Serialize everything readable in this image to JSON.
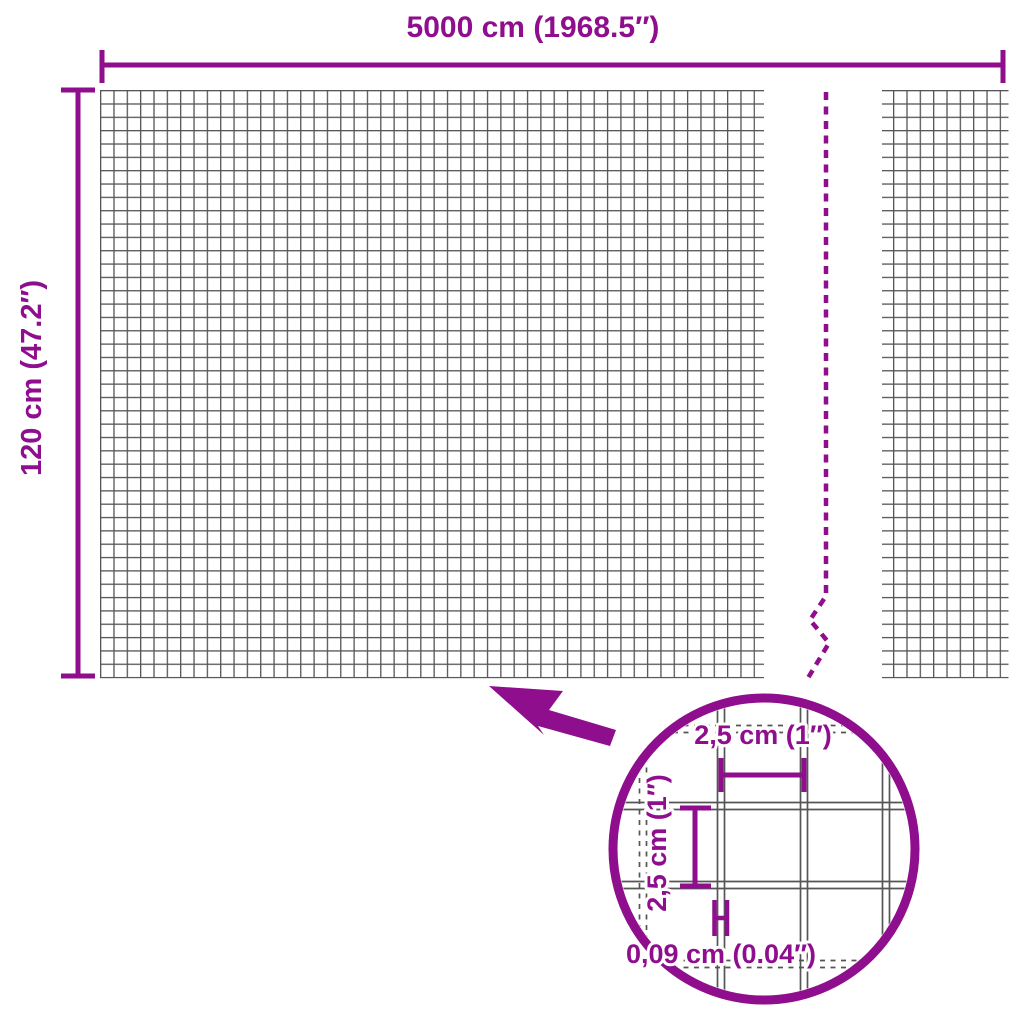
{
  "diagram": {
    "type": "product-dimension-diagram",
    "subject": "wire mesh fence roll",
    "accent_color": "#8E0E8E",
    "grid_color": "#555555",
    "background_color": "#FFFFFF",
    "width_dimension": {
      "label": "5000 cm (1968.5″)"
    },
    "height_dimension": {
      "label": "120 cm (47.2″)"
    },
    "break_line": {
      "style": "dashed",
      "meaning": "length continues (roll shortened in drawing)"
    },
    "detail_view": {
      "shape": "magnifier-circle",
      "mesh_cell_width": {
        "label": "2,5 cm (1″)"
      },
      "mesh_cell_height": {
        "label": "2,5 cm (1″)"
      },
      "wire_thickness": {
        "label": "0,09 cm (0.04″)"
      }
    }
  }
}
